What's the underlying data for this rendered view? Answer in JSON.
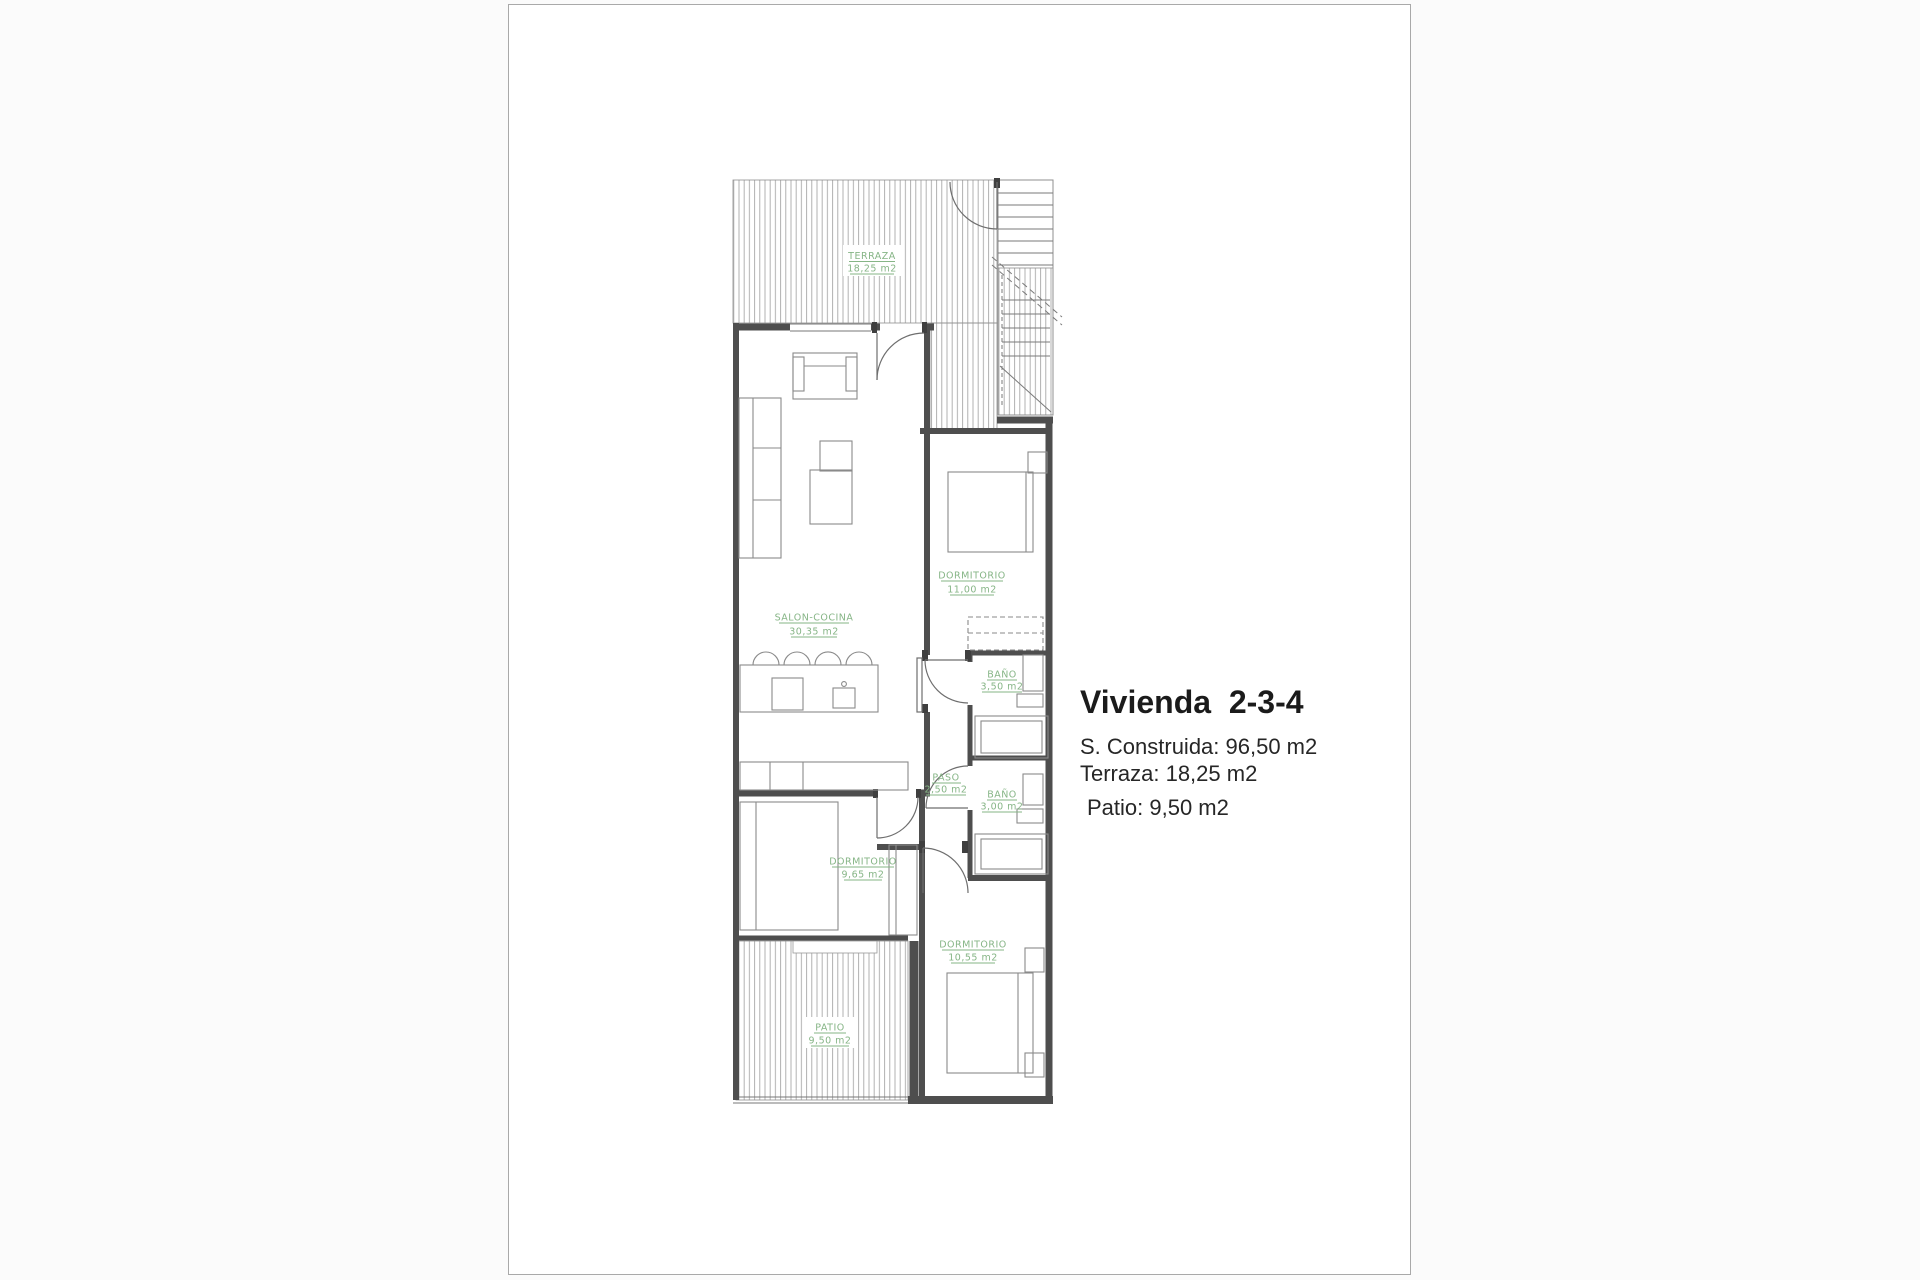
{
  "sheet": {
    "border_color": "#a9a9a9"
  },
  "info": {
    "title": "Vivienda  2-3-4",
    "line_construida": "S. Construida: 96,50 m2",
    "line_terraza": "Terraza: 18,25 m2",
    "line_patio": "Patio: 9,50 m2"
  },
  "plan": {
    "label_color": "#86b586",
    "rooms": {
      "terraza": {
        "name": "TERRAZA",
        "area": "18,25 m2"
      },
      "salon_cocina": {
        "name": "SALON-COCINA",
        "area": "30,35 m2"
      },
      "dormitorio_1": {
        "name": "DORMITORIO",
        "area": "11,00 m2"
      },
      "bano_1": {
        "name": "BAÑO",
        "area": "3,50 m2"
      },
      "paso": {
        "name": "PASO",
        "area": "2,50 m2"
      },
      "bano_2": {
        "name": "BAÑO",
        "area": "3,00 m2"
      },
      "dormitorio_2": {
        "name": "DORMITORIO",
        "area": "9,65 m2"
      },
      "dormitorio_3": {
        "name": "DORMITORIO",
        "area": "10,55 m2"
      },
      "patio": {
        "name": "PATIO",
        "area": "9,50 m2"
      }
    }
  }
}
